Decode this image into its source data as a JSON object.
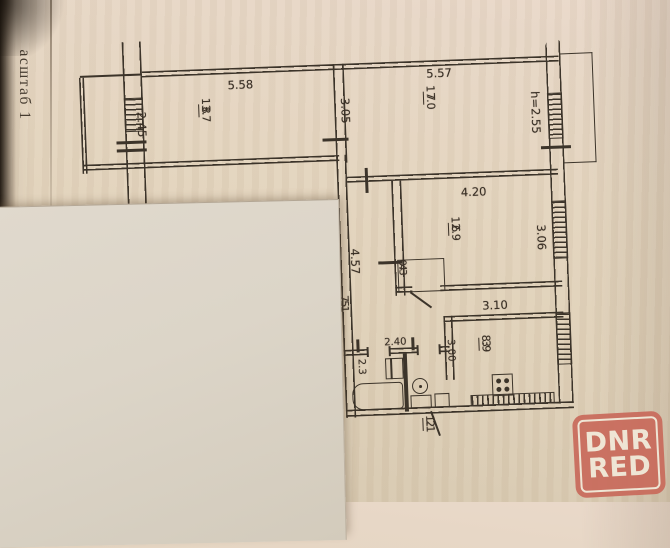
{
  "side_label": "асштаб 1",
  "watermark": {
    "line1": "DNR",
    "line2": "RED"
  },
  "rooms": [
    {
      "id": "8",
      "area": "13.7"
    },
    {
      "id": "7",
      "area": "17.0"
    },
    {
      "id": "6",
      "area": "12.9"
    },
    {
      "id": "4",
      "area": "0.3"
    },
    {
      "id": "5",
      "area": "7.1"
    },
    {
      "id": "3",
      "area": "8.9"
    },
    {
      "id": "2",
      "area": "1.1"
    }
  ],
  "dimensions": {
    "room8_width": "5.58",
    "room8_depth": "2.45",
    "room7_width": "5.57",
    "room7_depth": "3.05",
    "ceiling_height": "h=2.55",
    "room6_width": "4.20",
    "room6_depth": "3.06",
    "corridor_length": "4.57",
    "kitchen_width": "3.10",
    "kitchen_depth": "3.00",
    "bath_width": "2.40",
    "bath_depth": "2.3"
  },
  "colors": {
    "paper": "#e4d6c0",
    "line": "#3c342a",
    "sheet": "#dcd5c8",
    "wm": "#c96b5c",
    "wm-text": "#f1e8d8"
  }
}
